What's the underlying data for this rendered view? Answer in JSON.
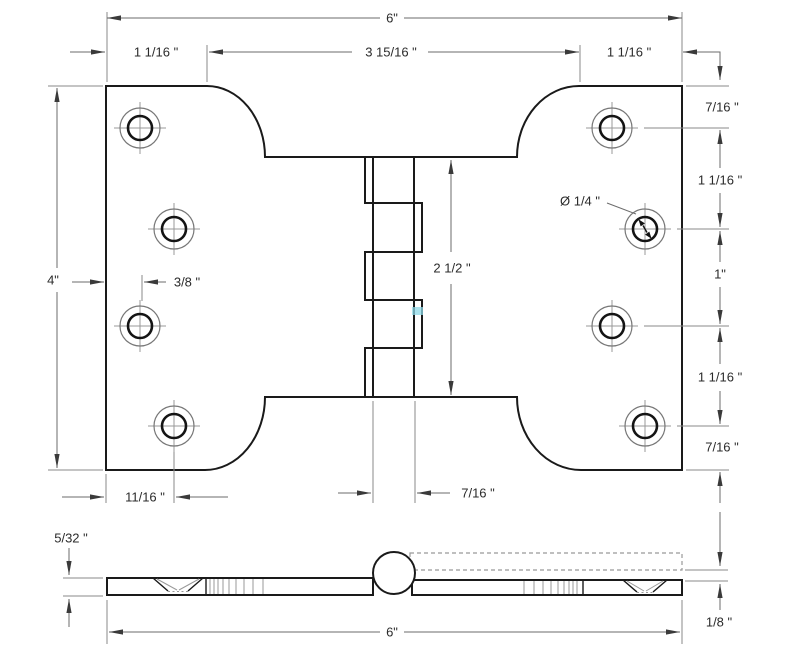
{
  "top_view": {
    "overall_width": "6\"",
    "overall_height": "4\"",
    "top_spans": [
      "1 1/16 \"",
      "3 15/16 \"",
      "1 1/16 \""
    ],
    "right_chain": [
      "7/16 \"",
      "1 1/16 \"",
      "1\"",
      "1 1/16 \"",
      "7/16 \""
    ],
    "hole_edge_offset": "3/8 \"",
    "hole_column_offset": "11/16 \"",
    "knuckle_width": "7/16 \"",
    "knuckle_height": "2 1/2 \"",
    "hole_diameter": "Ø 1/4 \""
  },
  "side_view": {
    "thickness": "5/32 \"",
    "overall_width": "6\"",
    "leaf_offset": "1/8 \""
  },
  "colors": {
    "object_line": "#1a1a1a",
    "dimension_line": "#6b6b6b",
    "watermark": "#8fd9e8"
  }
}
